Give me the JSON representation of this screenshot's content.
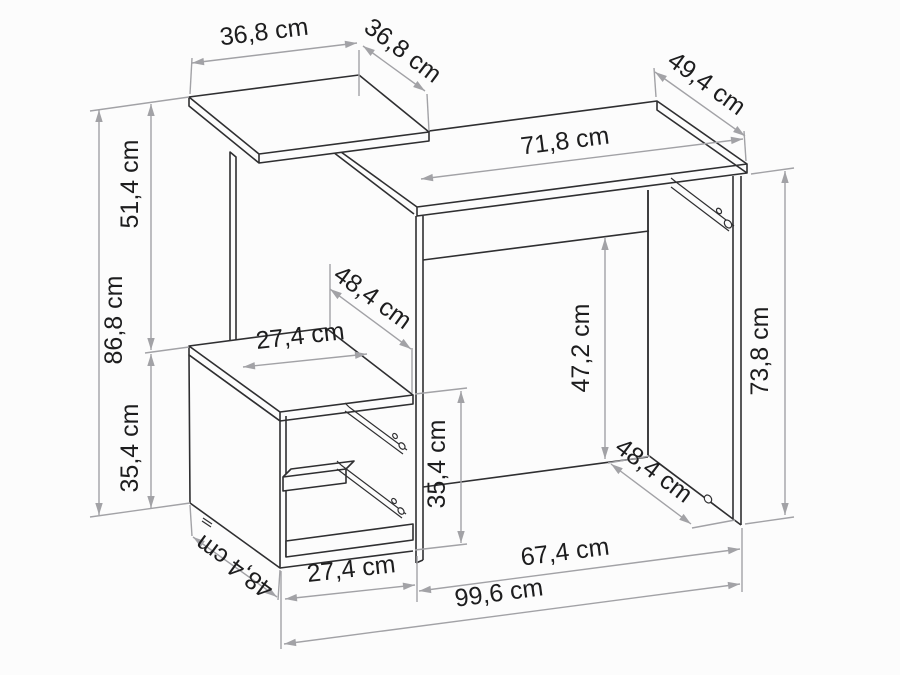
{
  "meta": {
    "diagram_type": "furniture-dimension-drawing",
    "subject": "desk-with-shelf-unit",
    "unit": "cm",
    "colors": {
      "background": "#fcfcfc",
      "furniture_line": "#2f2f31",
      "dimension_line": "#a2a2a6",
      "label_text": "#1d1d1e"
    }
  },
  "dimensions": [
    {
      "id": "top-shelf-width",
      "label": "36,8 cm",
      "value_cm": 36.8
    },
    {
      "id": "top-shelf-depth",
      "label": "36,8 cm",
      "value_cm": 36.8
    },
    {
      "id": "desk-top-depth",
      "label": "49,4 cm",
      "value_cm": 49.4
    },
    {
      "id": "desk-top-width",
      "label": "71,8 cm",
      "value_cm": 71.8
    },
    {
      "id": "upper-section-height",
      "label": "51,4 cm",
      "value_cm": 51.4
    },
    {
      "id": "total-height",
      "label": "86,8 cm",
      "value_cm": 86.8
    },
    {
      "id": "lower-section-height",
      "label": "35,4 cm",
      "value_cm": 35.4
    },
    {
      "id": "middle-depth",
      "label": "48,4 cm",
      "value_cm": 48.4
    },
    {
      "id": "middle-shelf-width",
      "label": "27,4 cm",
      "value_cm": 27.4
    },
    {
      "id": "cabinet-front-height",
      "label": "35,4 cm",
      "value_cm": 35.4
    },
    {
      "id": "under-desk-height",
      "label": "47,2 cm",
      "value_cm": 47.2
    },
    {
      "id": "desk-side-height",
      "label": "73,8 cm",
      "value_cm": 73.8
    },
    {
      "id": "desk-bottom-depth",
      "label": "48,4 cm",
      "value_cm": 48.4
    },
    {
      "id": "under-desk-width",
      "label": "67,4 cm",
      "value_cm": 67.4
    },
    {
      "id": "total-width",
      "label": "99,6 cm",
      "value_cm": 99.6
    },
    {
      "id": "cabinet-bottom-width",
      "label": "27,4 cm",
      "value_cm": 27.4
    },
    {
      "id": "cabinet-bottom-depth",
      "label": "48,4 cm",
      "value_cm": 48.4
    }
  ]
}
